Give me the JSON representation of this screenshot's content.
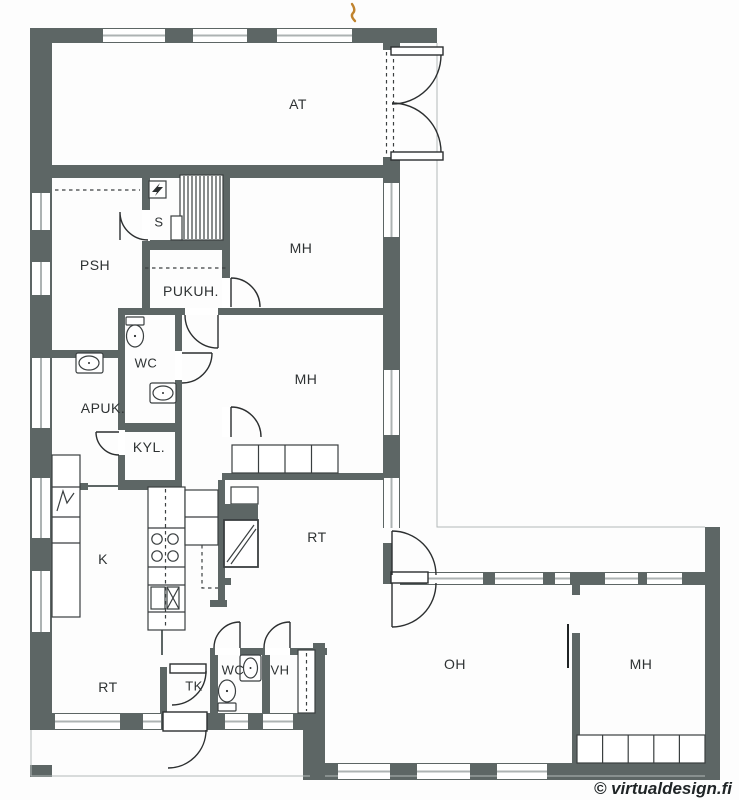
{
  "plan": {
    "title": "L-shaped house floor plan",
    "rooms": {
      "at": "AT",
      "s": "S",
      "psh": "PSH",
      "pukuh": "PUKUH.",
      "mh_top": "MH",
      "wc_mid": "WC",
      "apuk": "APUK.",
      "kyl": "KYL.",
      "mh_mid": "MH",
      "k": "K",
      "rt_mid": "RT",
      "rt_bottom": "RT",
      "tk": "TK",
      "wc_bottom": "WC",
      "vh": "VH",
      "oh": "OH",
      "mh_bottom": "MH"
    },
    "watermark": "© virtualdesign.fi",
    "colors": {
      "wall": "#5d6665",
      "glass_line": "#adb3b3",
      "line": "#2c2f30",
      "label": "#2e3233",
      "scan_mark": "#c0832e",
      "background": "#fdfdfd"
    },
    "icons": [
      "stairs",
      "electrical-panel-icon",
      "toilet-icon",
      "sink-icon",
      "stove-icon",
      "fireplace-icon",
      "wardrobe",
      "door-swing",
      "window",
      "garage-door",
      "entrance-door",
      "double-swing-door"
    ]
  }
}
